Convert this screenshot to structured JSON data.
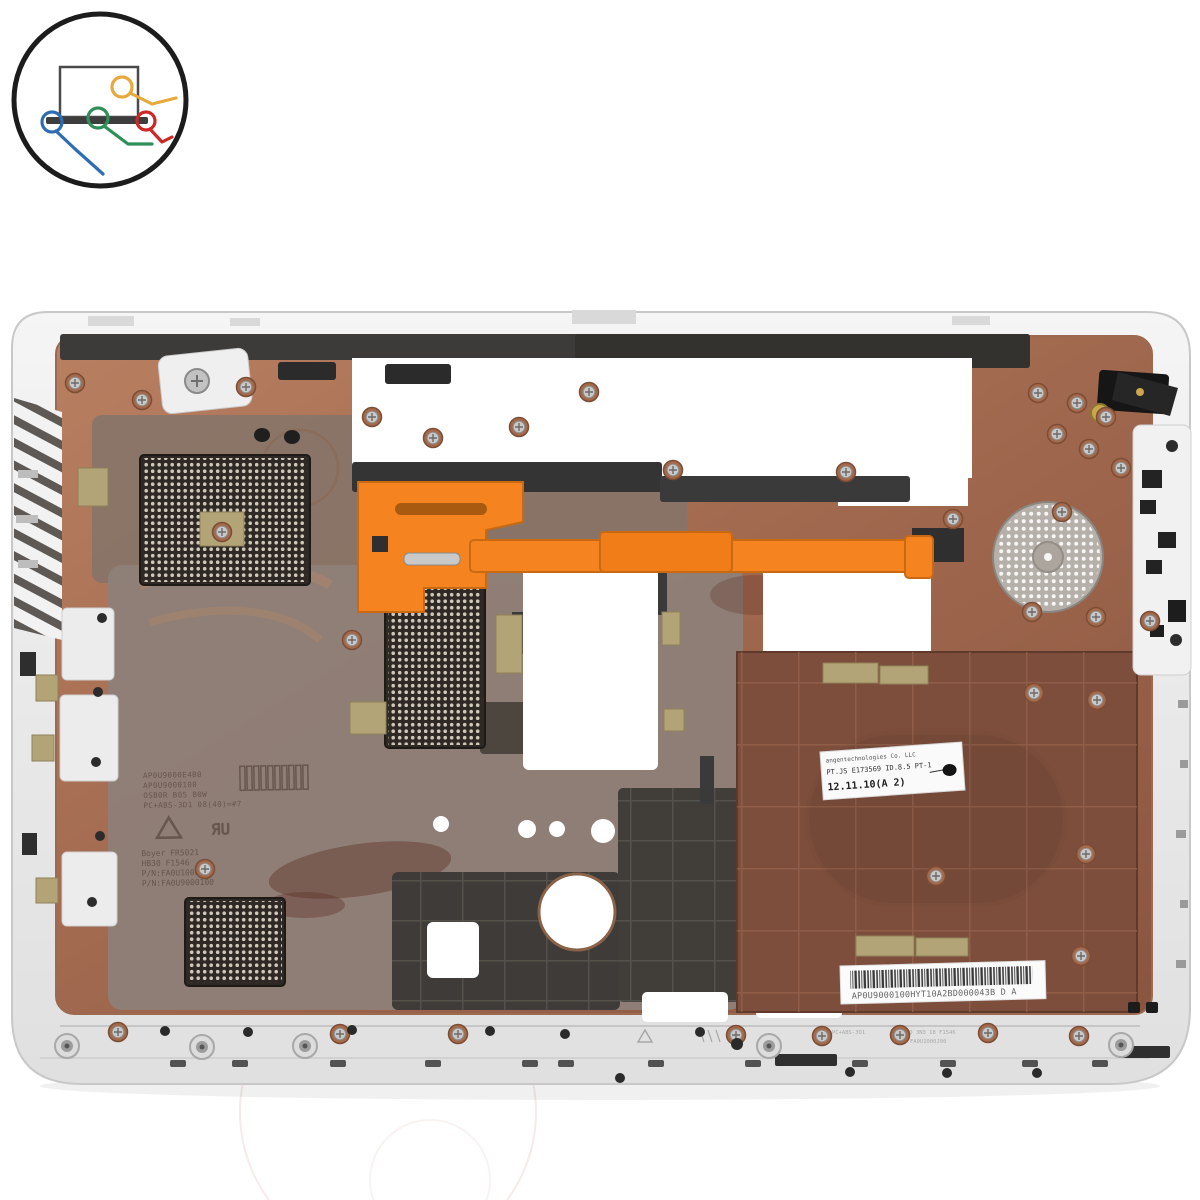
{
  "image": {
    "kind": "product-photo",
    "subject": "laptop bottom base cover spare part, top-down view",
    "background_color": "#ffffff"
  },
  "logo": {
    "name": "laptop-parts-shop-logo",
    "ring_color": "#1c1c1c",
    "laptop_color": "#3d3d3d",
    "wires": [
      {
        "name": "blue-wire",
        "color": "#2e6db4"
      },
      {
        "name": "green-wire",
        "color": "#2e9058"
      },
      {
        "name": "yellow-wire",
        "color": "#e7a93c"
      },
      {
        "name": "red-wire",
        "color": "#ce2727"
      }
    ]
  },
  "case": {
    "shell_color": "#ededed",
    "shield_copper_color": "#a96e52",
    "inner_gray_color": "#8d7f77",
    "dark_plastic_color": "#3a3835",
    "latch_color": "#f5831f",
    "emi_pad_color": "#b3a478",
    "speaker_color": "#b5b0a9"
  },
  "molded_text": {
    "lines": [
      "AP0U9000E4B0",
      "AP0U9000100",
      "OSB0R B05 B0W",
      "PC+ABS-3D1 08(40)=#7",
      "Boyer FR5021",
      "HB30 F1546",
      "P/N:FA0U1000J00",
      "P/N:FA0U9000100"
    ]
  },
  "spec_label": {
    "line1": "angentechnologies Co. LLC",
    "line2": "PT.JS E173569 ID.8.5 PT-1",
    "line3": "12.11.10(A  2)"
  },
  "barcode_label": {
    "text": "AP0U9000100HYT10A2BD000043B  D A"
  },
  "rim_engraving": {
    "lines": [
      "PC+ABS-3D1",
      "JO 3N3 18 F1546",
      "FA0U1000J00"
    ]
  }
}
